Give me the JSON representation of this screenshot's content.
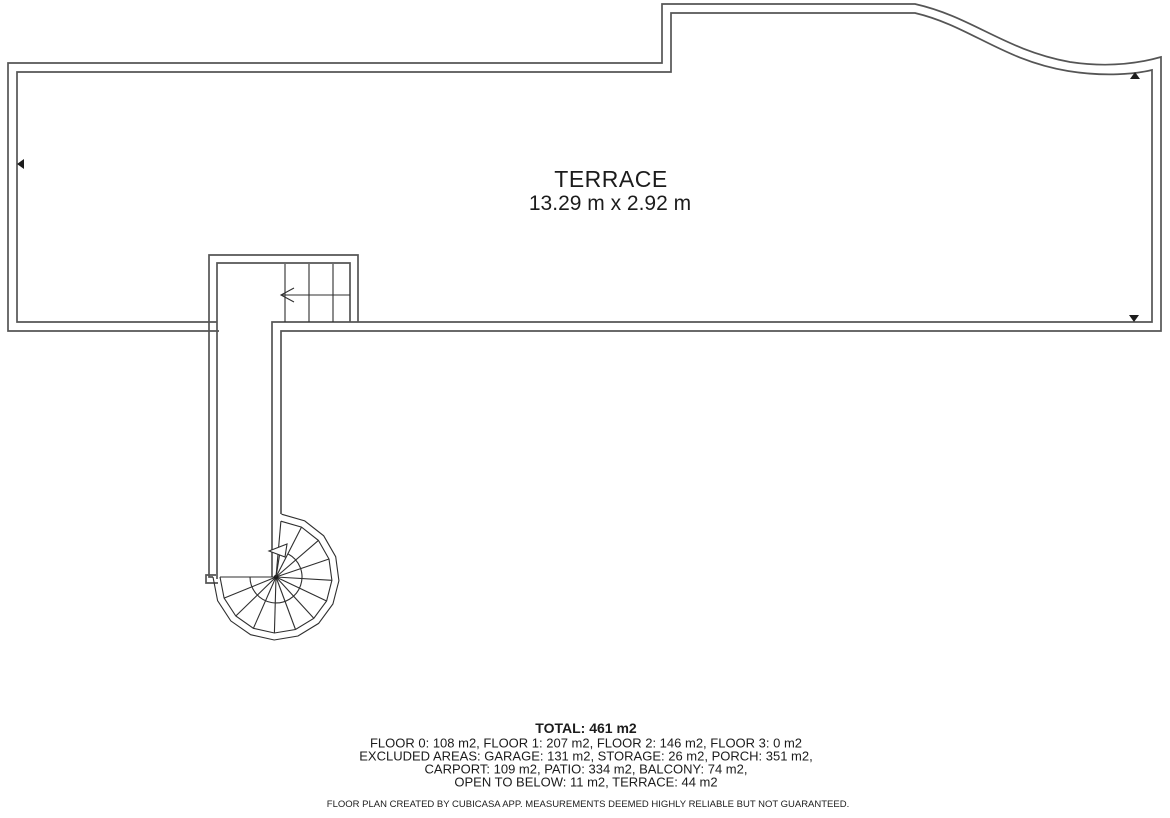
{
  "plan": {
    "room": {
      "name": "TERRACE",
      "dimensions": "13.29 m x 2.92 m"
    },
    "summary": {
      "total": "TOTAL: 461 m2",
      "lines": [
        "FLOOR 0: 108 m2, FLOOR 1: 207 m2, FLOOR 2: 146 m2, FLOOR 3: 0 m2",
        "EXCLUDED AREAS: GARAGE: 131 m2, STORAGE: 26 m2, PORCH: 351 m2,",
        "CARPORT: 109 m2, PATIO: 334 m2, BALCONY: 74 m2,",
        "OPEN TO BELOW: 11 m2, TERRACE: 44 m2"
      ],
      "disclaimer": "FLOOR PLAN CREATED BY CUBICASA APP. MEASUREMENTS DEEMED HIGHLY RELIABLE BUT NOT GUARANTEED."
    },
    "colors": {
      "wall": "#555555",
      "stair_line": "#2f2f2f",
      "text": "#1c1c1c",
      "background": "#ffffff"
    },
    "spiral_stair": {
      "cx": 276,
      "cy": 577,
      "outer_r": 63,
      "inner_r": 56,
      "hub_r": 26,
      "start_angle": -85,
      "end_angle": 180,
      "hub_start_angle": -62,
      "hub_end_angle": 180,
      "treads": 13
    }
  }
}
